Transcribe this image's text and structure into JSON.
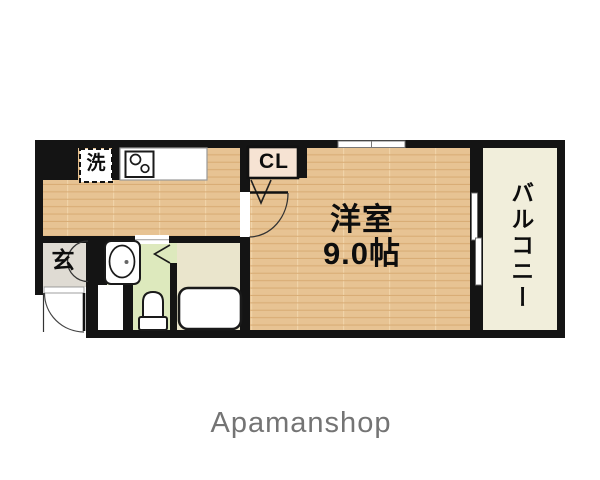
{
  "floorplan": {
    "labels": {
      "washer": "洗",
      "closet": "CL",
      "room_name": "洋室",
      "room_size": "9.0帖",
      "balcony": "バルコニー",
      "entrance": "玄"
    },
    "fixtures": {
      "stove": "two-burner-stove",
      "washer_box": "washing-machine-space",
      "vanity": "washbasin",
      "toilet": "toilet",
      "bathtub": "bathtub",
      "doors": [
        "entrance-swing-door",
        "main-room-swing-door",
        "closet-bifold-door",
        "bathroom-bifold-door",
        "entrance-storage-double-door",
        "balcony-sliding-door",
        "top-sliding-window"
      ]
    },
    "colors": {
      "wall": "#141414",
      "wood_floor": "#e7c393",
      "wood_stripe": "#d9ad76",
      "balcony_floor": "#f1eedb",
      "bathroom_floor": "#eae5cc",
      "washroom_floor": "#dde9bd",
      "entrance_floor": "#dfdbd3",
      "closet_fill": "#f6e3d3"
    },
    "branding": {
      "logo_text": "Apamanshop",
      "logo_color": "#747474"
    }
  }
}
